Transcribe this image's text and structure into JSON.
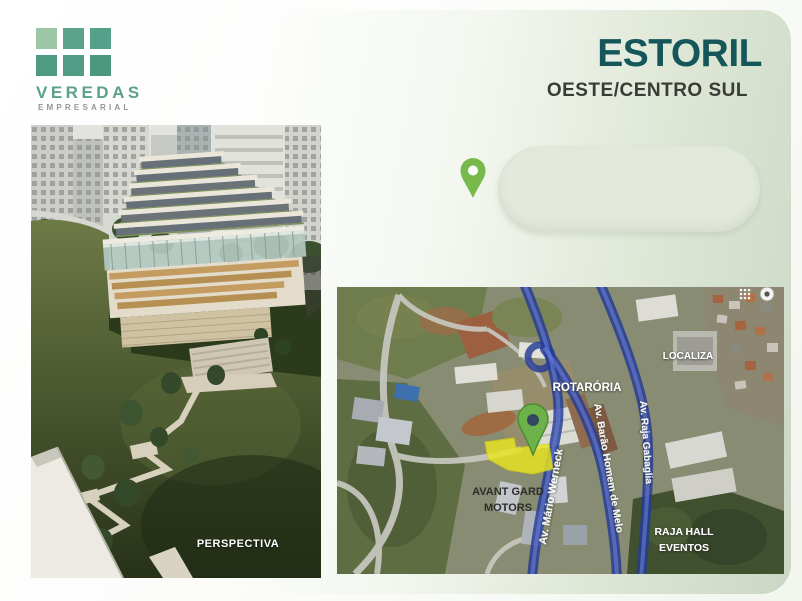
{
  "brand": {
    "name": "VEREDAS",
    "tagline": "EMPRESARIAL"
  },
  "header": {
    "title": "ESTORIL",
    "subtitle": "OESTE/CENTRO SUL"
  },
  "perspective": {
    "caption": "PERSPECTIVA"
  },
  "map": {
    "pois": {
      "rotatoria": "ROTARÓRIA",
      "localiza": "LOCALIZA",
      "avant_gard_line1": "AVANT GARD",
      "avant_gard_line2": "MOTORS",
      "raja_hall_line1": "RAJA HALL",
      "raja_hall_line2": "EVENTOS"
    },
    "roads": {
      "werneck": "Av. Mário Werneck",
      "barao": "Av. Barão Homem de Melo",
      "raja": "Av. Raja Gabaglia"
    },
    "colors": {
      "road_overlay_blue": "#2f4ab0",
      "lot_highlight_yellow": "#e9e620",
      "map_pin_green": "#6cb14a"
    }
  },
  "callout": {
    "pin_color": "#77ba4b"
  },
  "theme": {
    "title_teal": "#14565a",
    "logo_teal": "#549d86",
    "logo_light_green": "#9cc6a5",
    "panel_sage": "#cbd7c4"
  }
}
